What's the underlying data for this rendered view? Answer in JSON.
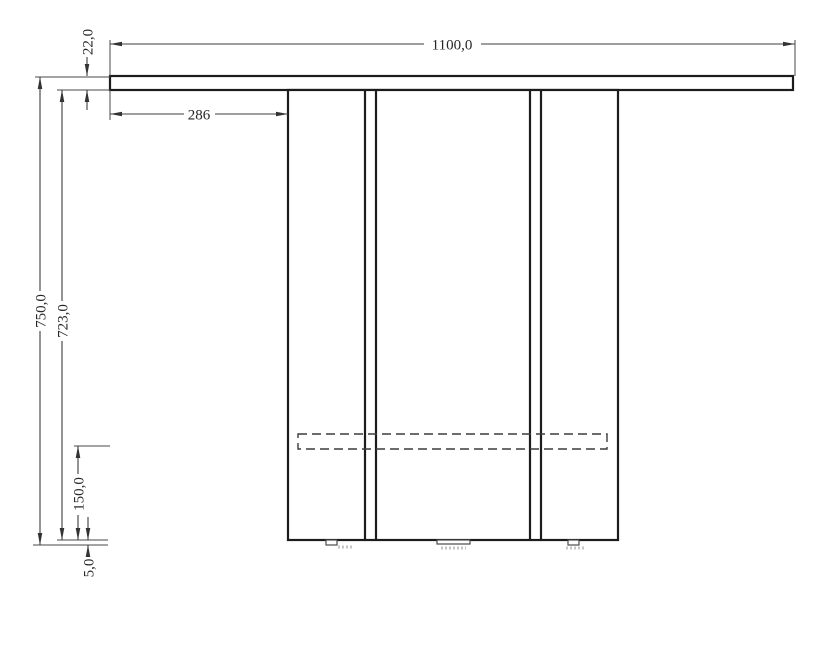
{
  "drawing": {
    "type": "technical-elevation",
    "subject": "pedestal-table-side-view",
    "colors": {
      "background": "#ffffff",
      "object_line": "#1c1c1c",
      "dimension_line": "#3d3d3d",
      "hidden_line": "#3c3c3c",
      "text": "#262626"
    },
    "dimensions": {
      "top_width": "1100,0",
      "top_thickness": "22,0",
      "left_overhang": "286",
      "total_height": "750,0",
      "pedestal_height": "723,0",
      "stretcher_bottom_height": "150,0",
      "glide_height": "5,0"
    }
  }
}
